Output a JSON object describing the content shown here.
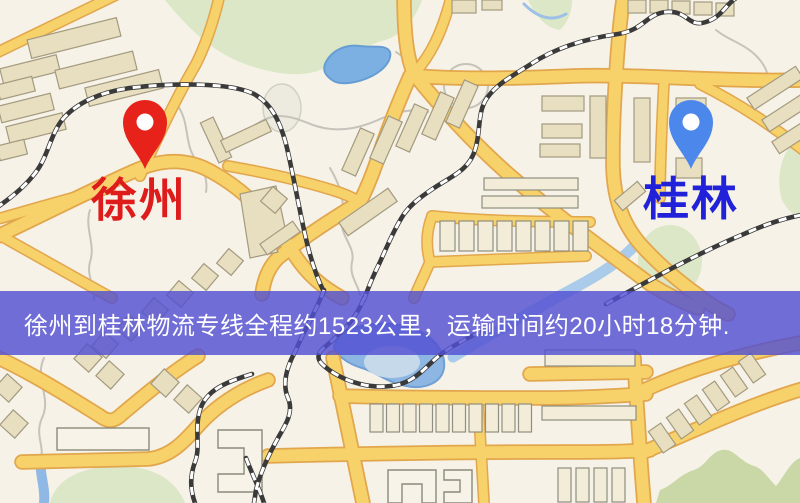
{
  "map": {
    "markers": [
      {
        "name": "xuzhou",
        "label": "徐州",
        "pin_color": "#e7221a",
        "label_color": "#de1c1c",
        "icon": "map-pin-icon"
      },
      {
        "name": "guilin",
        "label": "桂林",
        "pin_color": "#4c87ec",
        "label_color": "#2121da",
        "icon": "map-pin-icon"
      }
    ],
    "banner": {
      "text": "徐州到桂林物流专线全程约1523公里，运输时间约20小时18分钟.",
      "background_color": "#524fd2",
      "text_color": "#ffffff"
    },
    "palette": {
      "land": "#f6f2e7",
      "road_fill": "#f7d169",
      "road_casing": "#e2a64d",
      "water": "#7cb0e2",
      "park_green": "#dbe7c6",
      "railway": "#3a3a3a",
      "building": "#e8dfc0"
    }
  }
}
